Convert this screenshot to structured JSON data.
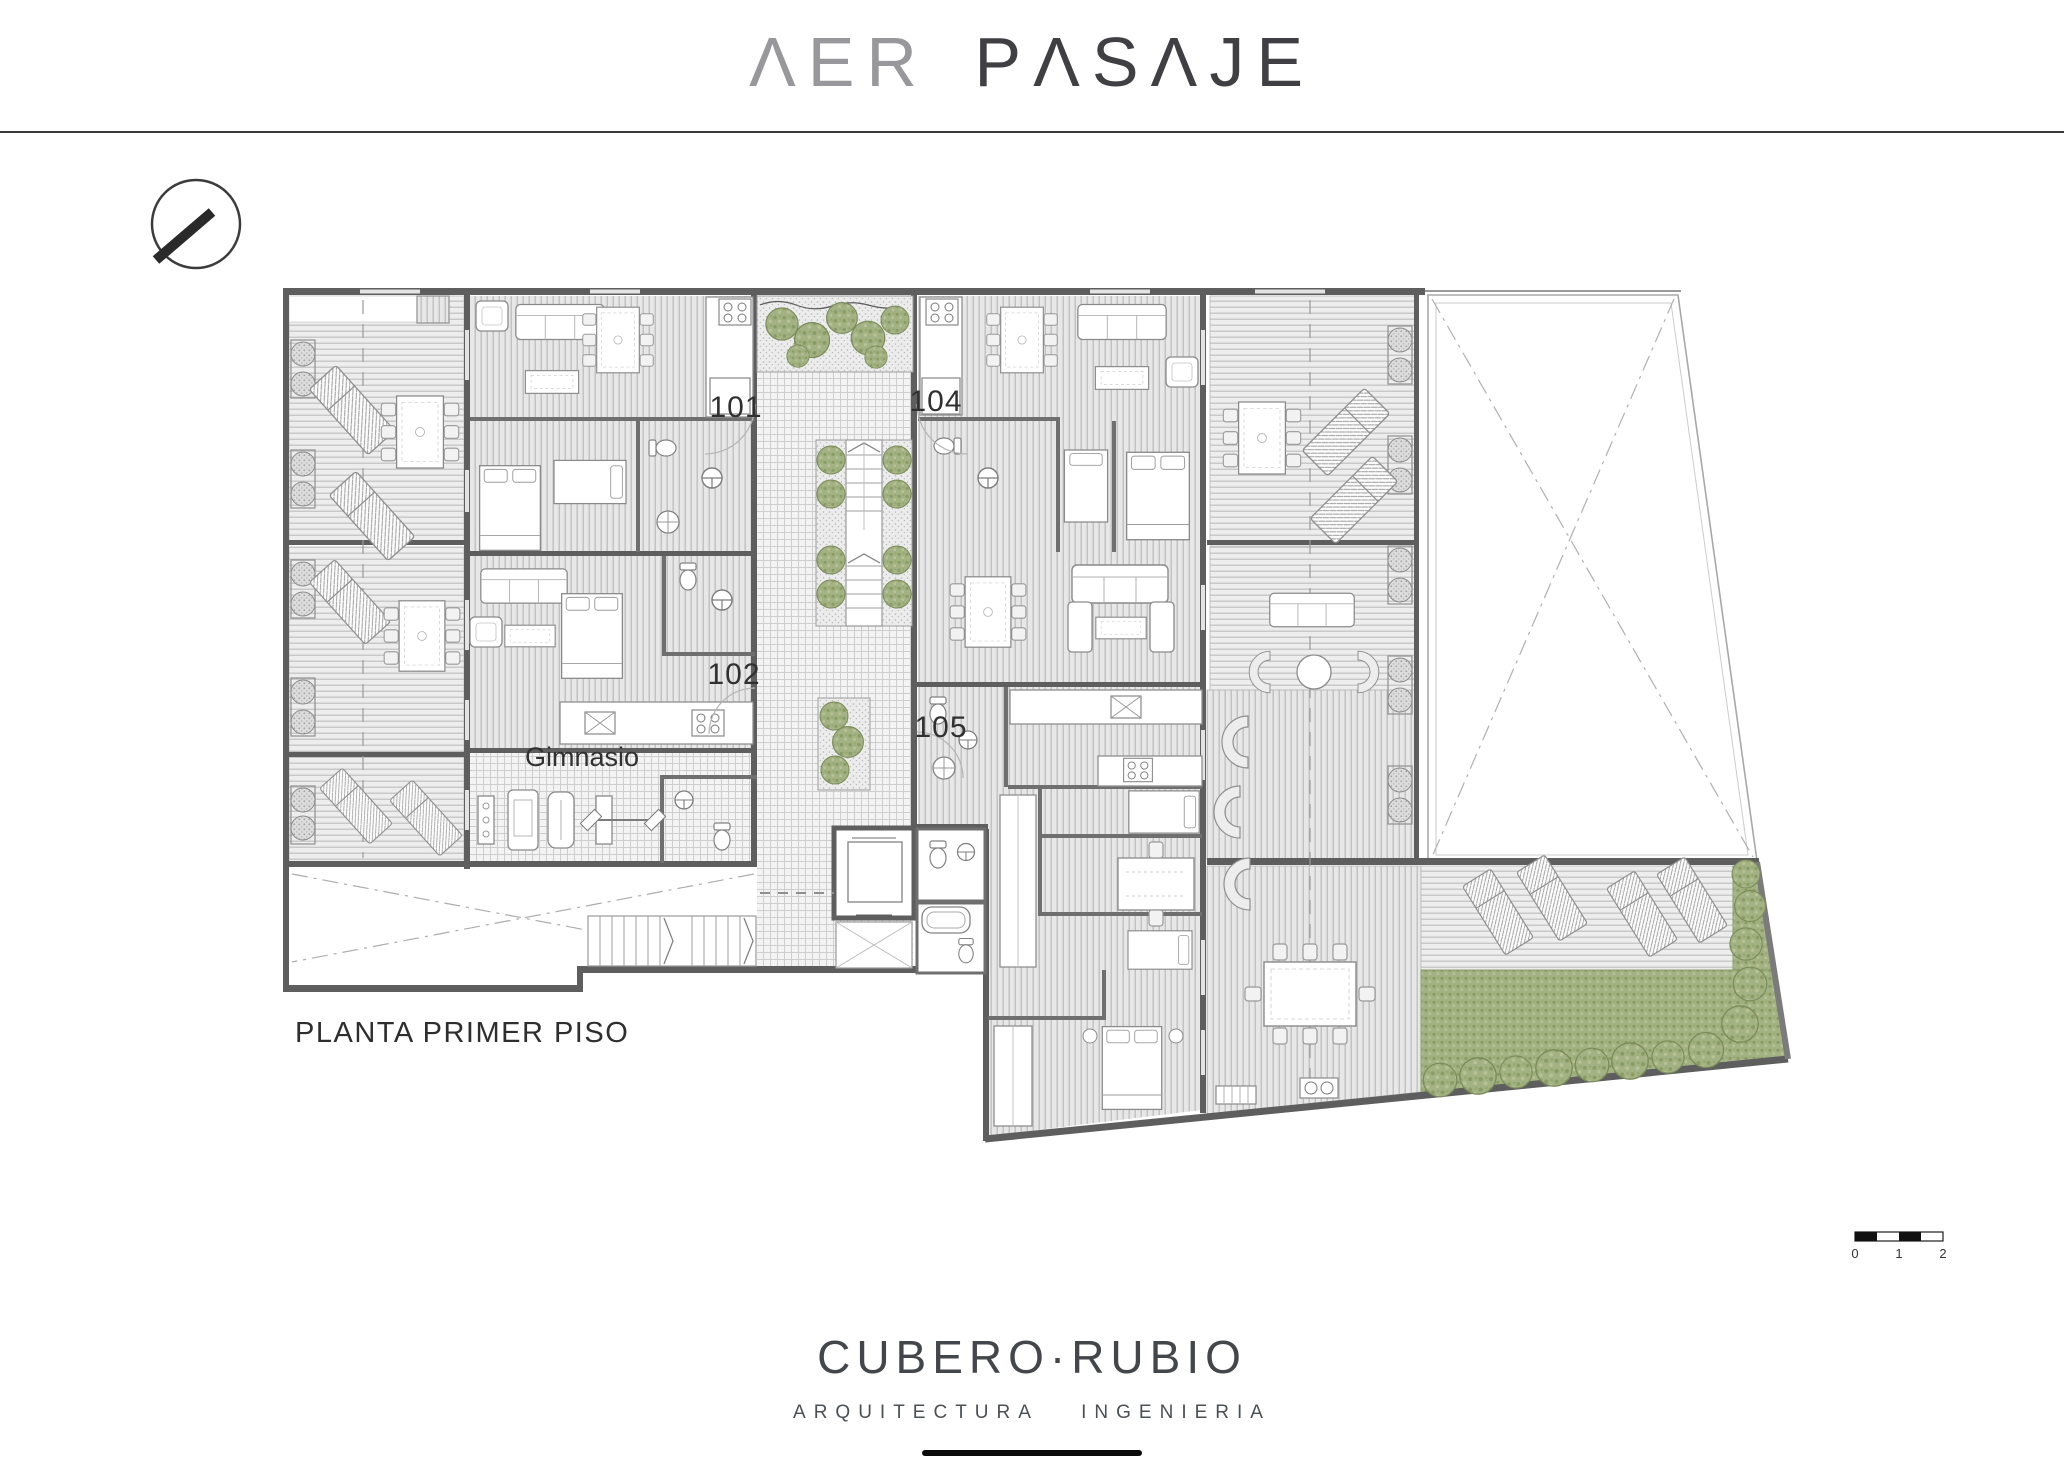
{
  "header": {
    "brand_aer": "ΛER",
    "brand_pasaje": "PΛSΛJE"
  },
  "plan": {
    "title": "PLANTA PRIMER PISO",
    "units": {
      "u101": "101",
      "u102": "102",
      "u104": "104",
      "u105": "105"
    },
    "gym": "Gimnasio"
  },
  "scale_bar": {
    "t0": "0",
    "t1": "1",
    "t2": "2"
  },
  "footer": {
    "studio": "CUBERO·RUBIO",
    "tagline_word1": "ARQUITECTURA",
    "tagline_word2": "INGENIERIA"
  },
  "colors": {
    "wall": "#5e5e5e",
    "green": "#a3b282",
    "accent_text": "#303030"
  }
}
